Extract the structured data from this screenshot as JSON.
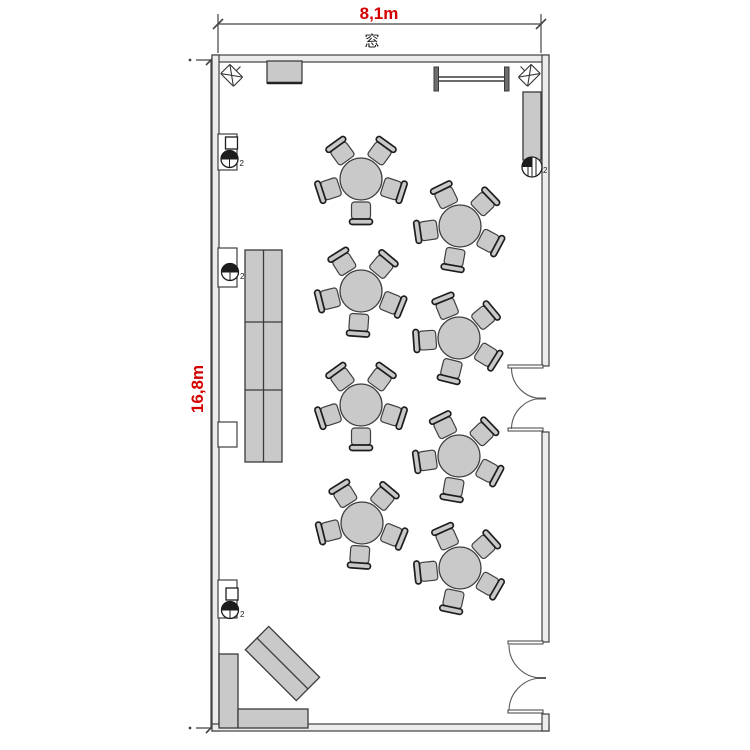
{
  "plan": {
    "type": "banquet-room-floor-plan",
    "dimensions": {
      "width_label": "8,1m",
      "height_label": "16,8m"
    },
    "window_label": "窓",
    "colors": {
      "dimension_text": "#d40000",
      "line": "#3f3f3f",
      "furniture_fill": "#c9c9c9",
      "wall_fill": "#ececec",
      "dark": "#1d1d1d"
    },
    "round_tables_count": 8,
    "seats_per_table": 5,
    "chair_base_angles": [
      -126,
      -54,
      18,
      90,
      162
    ],
    "tables": [
      {
        "cx": 361,
        "cy": 179,
        "offset": 0
      },
      {
        "cx": 460,
        "cy": 226,
        "offset": 10
      },
      {
        "cx": 361,
        "cy": 291,
        "offset": 4
      },
      {
        "cx": 459,
        "cy": 338,
        "offset": 14
      },
      {
        "cx": 361,
        "cy": 405,
        "offset": 0
      },
      {
        "cx": 459,
        "cy": 456,
        "offset": 10
      },
      {
        "cx": 362,
        "cy": 523,
        "offset": 4
      },
      {
        "cx": 460,
        "cy": 568,
        "offset": 12
      }
    ],
    "wall_outlets": [
      {
        "x": 229.5,
        "y": 159,
        "label": "2",
        "square": true
      },
      {
        "x": 230,
        "y": 272,
        "label": "2",
        "square": false
      },
      {
        "x": 230,
        "y": 610,
        "label": "2",
        "square": true
      }
    ],
    "column_outlet": {
      "x": 532,
      "y": 167,
      "label": "2"
    }
  }
}
